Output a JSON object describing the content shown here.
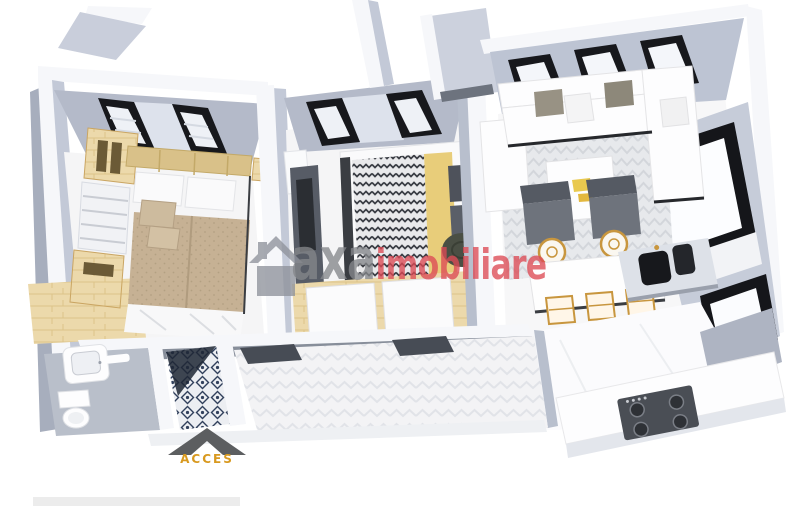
{
  "watermark": {
    "brand_prefix": "axa",
    "brand_suffix": "imobiliare",
    "prefix_color": "#85878b",
    "suffix_color": "#dd4b55",
    "house_icon_color": "#8f939c"
  },
  "access_marker": {
    "label": "ACCES",
    "label_color": "#d8991f",
    "arrow_color": "#5c5e60"
  },
  "footer_bar": {
    "color": "#ececec"
  },
  "palette": {
    "background": "#ffffff",
    "wall_top": "#f6f7fa",
    "wall_face": "#c3c9d7",
    "wall_face_dark": "#a7aebd",
    "ceiling_slope": "#b4bac9",
    "window_frame": "#17181c",
    "glass": "#eef1f6",
    "floor_white": "#f5f5f6",
    "wood": "#ecd9ab",
    "duvet_tan": "#c6b194",
    "accent_yellow": "#e8cd7a",
    "tile_navy": "#31405c",
    "appliance_dark": "#4a4e55",
    "gold": "#c8963e"
  }
}
